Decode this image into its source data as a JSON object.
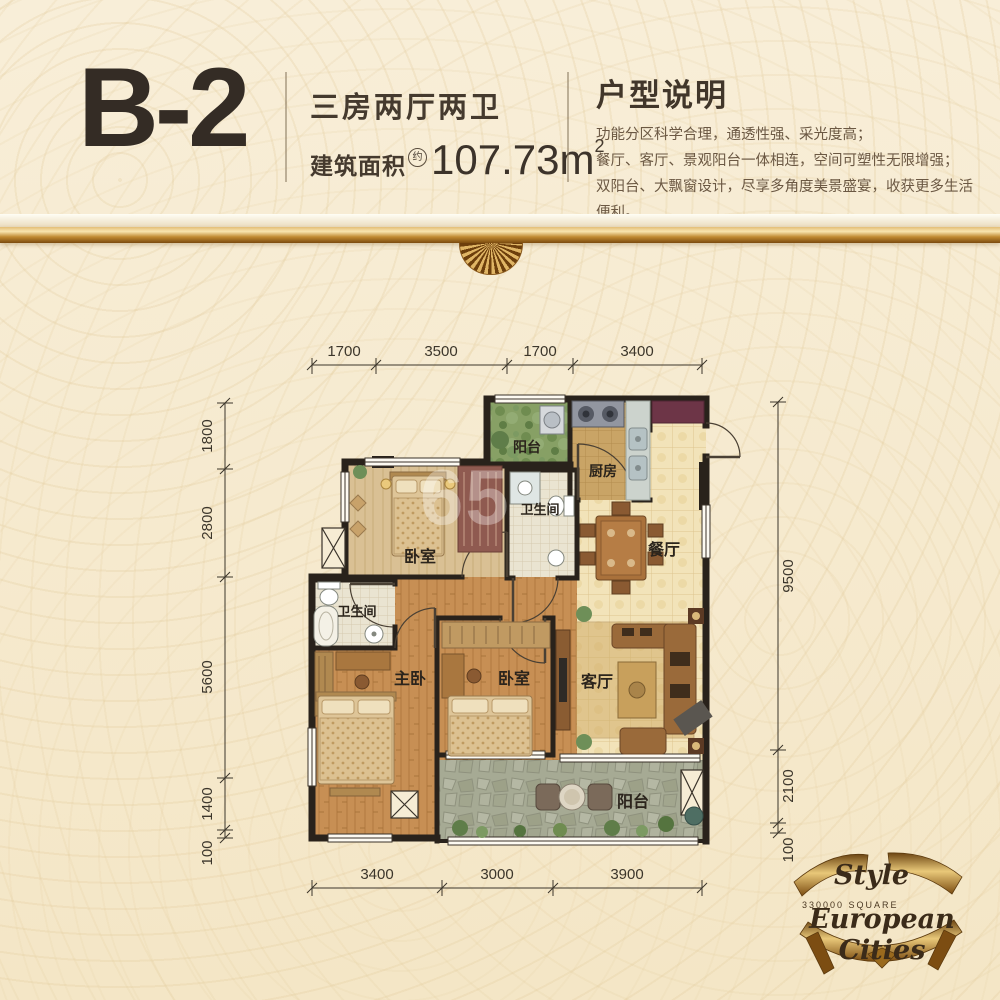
{
  "header": {
    "unit": "B-2",
    "type": "三房两厅两卫",
    "area_label": "建筑面积",
    "area_approx": "约",
    "area_value": "107.73m",
    "area_sup": "2",
    "desc_title": "户型说明",
    "desc_lines": [
      "功能分区科学合理，通透性强、采光度高；",
      "餐厅、客厅、景观阳台一体相连，空间可塑性无限增强；",
      "双阳台、大飘窗设计，尽享多角度美景盛宴，收获更多生活便利。"
    ]
  },
  "plan": {
    "rooms": {
      "balcony_top": "阳台",
      "kitchen": "厨房",
      "bath_upper": "卫生间",
      "bedroom_top": "卧室",
      "dining": "餐厅",
      "bath_lower": "卫生间",
      "master": "主卧",
      "bedroom_mid": "卧室",
      "living": "客厅",
      "balcony_bottom": "阳台"
    },
    "dims": {
      "top": [
        "1700",
        "3500",
        "1700",
        "3400"
      ],
      "bottom": [
        "3400",
        "3000",
        "3900"
      ],
      "left": [
        "1800",
        "2800",
        "5600",
        "1400",
        "100"
      ],
      "right": [
        "9500",
        "2100",
        "100"
      ]
    }
  },
  "watermark": {
    "text": "65"
  },
  "logo": {
    "style": "Style",
    "square": "330000  SQUARE",
    "name": "European Cities"
  },
  "colors": {
    "background": "#f6e9cd",
    "wall": "#29221b",
    "accent_gold": "#b98a3e",
    "tile": "#f2e3b9",
    "wood": "#c58d52"
  }
}
